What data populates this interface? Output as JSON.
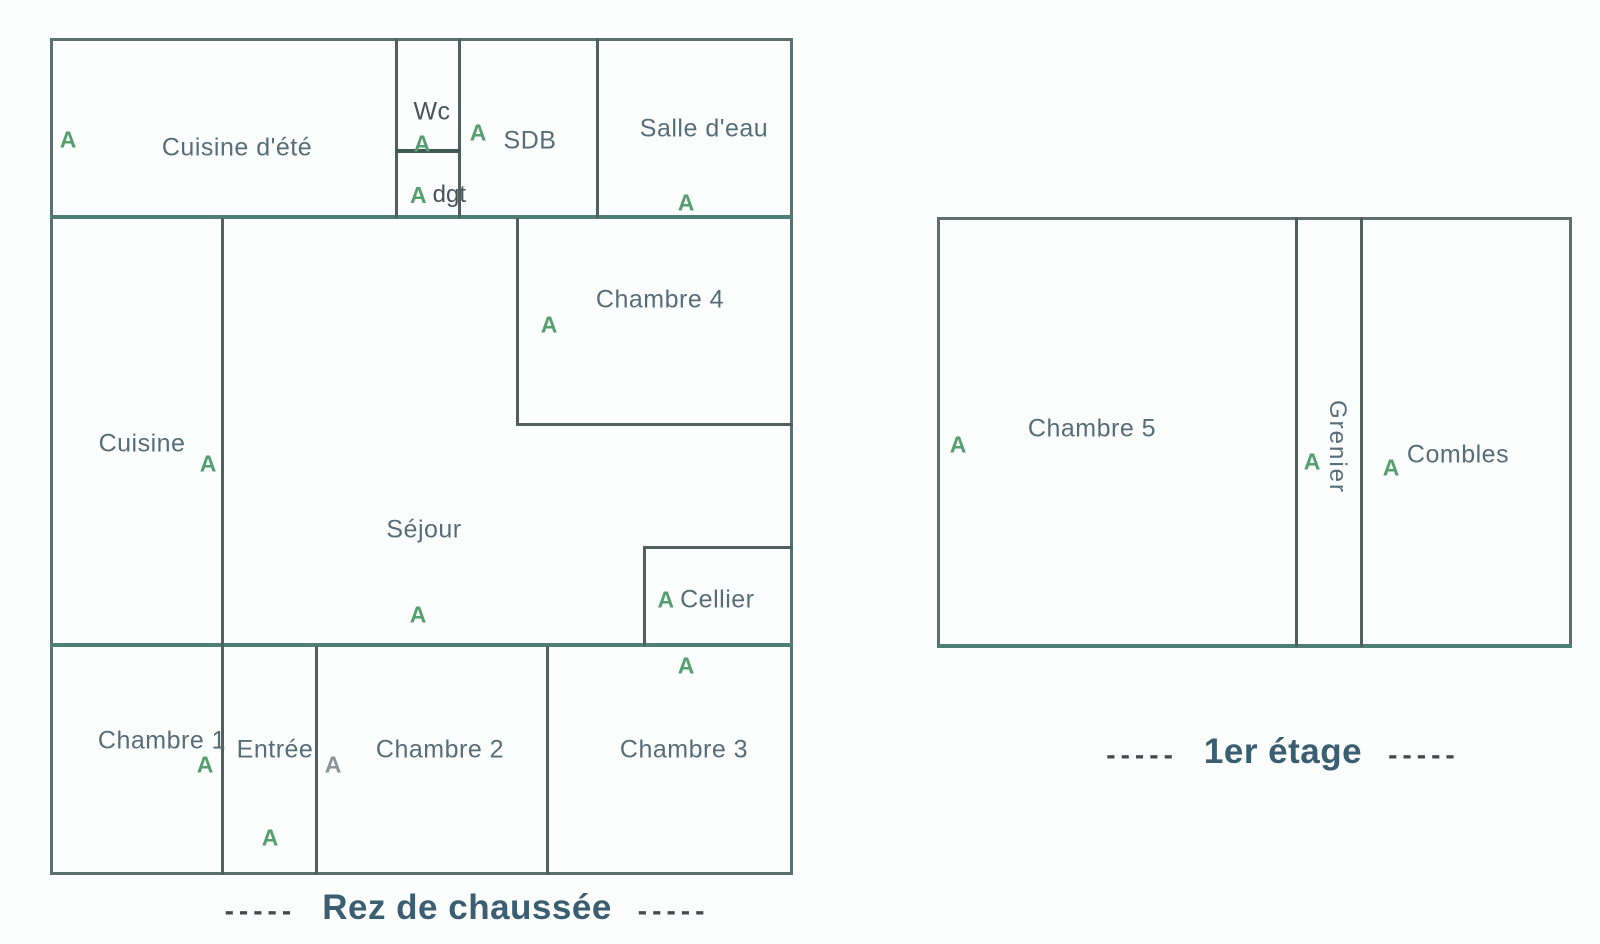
{
  "document_type": "floor-plan",
  "marker_glyph": "A",
  "colors": {
    "wall": "#4f605d",
    "wall_accent_teal": "#4e7f74",
    "room_label": "#566e7a",
    "caption_text": "#3a5f73",
    "caption_dashes": "#44494c",
    "marker_green": "#55a06e",
    "marker_gray": "#8b969a",
    "background": "#fcfdfd"
  },
  "ground_floor": {
    "caption": "Rez de chaussée",
    "dash_left": "-----",
    "dash_right": "-----",
    "rooms": {
      "cuisine_ete": "Cuisine d'été",
      "wc": "Wc",
      "dgt": "dgt",
      "sdb": "SDB",
      "salle_eau": "Salle d'eau",
      "chambre4": "Chambre 4",
      "cuisine": "Cuisine",
      "sejour": "Séjour",
      "cellier": "Cellier",
      "chambre1": "Chambre 1",
      "entree": "Entrée",
      "chambre2": "Chambre 2",
      "chambre3": "Chambre 3"
    }
  },
  "first_floor": {
    "caption": "1er étage",
    "dash_left": "-----",
    "dash_right": "-----",
    "rooms": {
      "chambre5": "Chambre 5",
      "grenier": "Grenier",
      "combles": "Combles"
    }
  }
}
